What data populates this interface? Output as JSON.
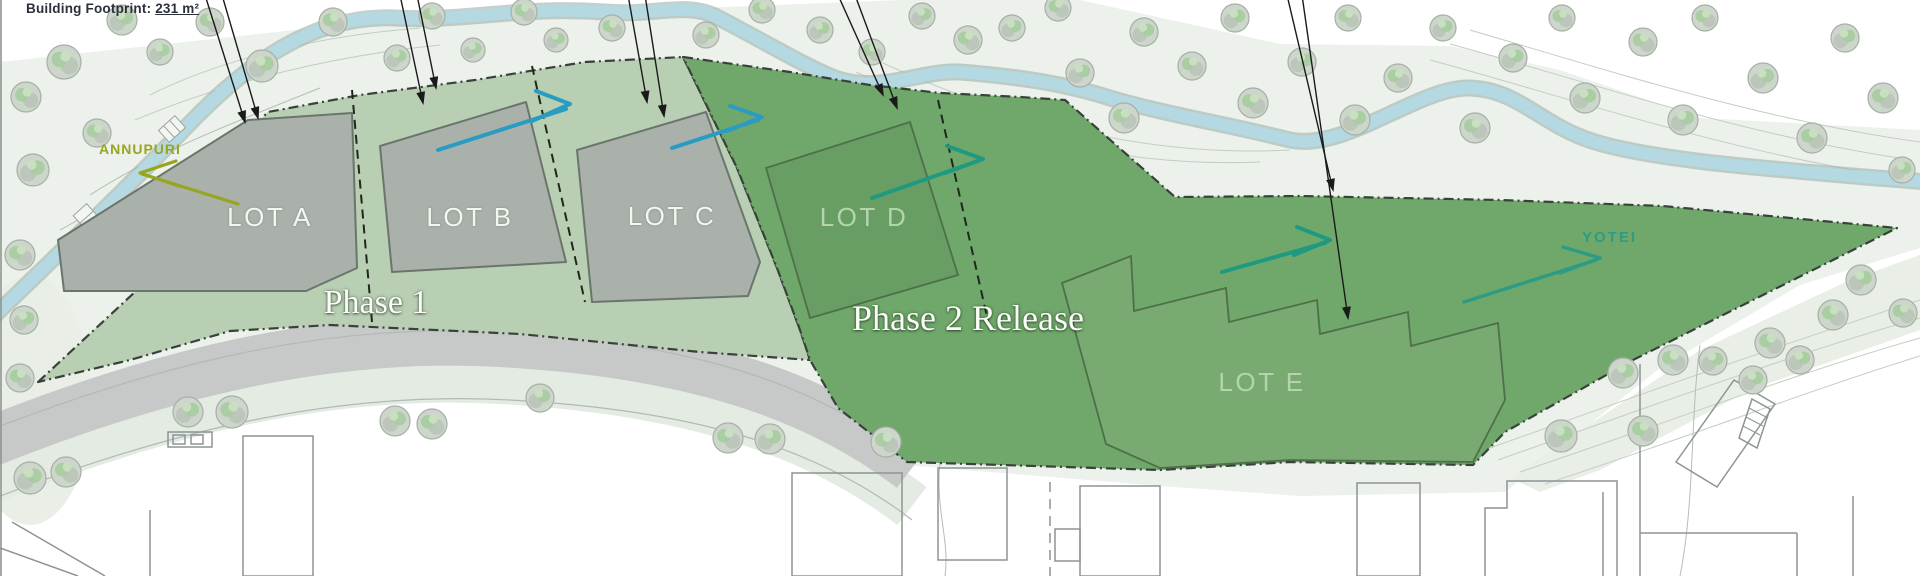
{
  "annotation": {
    "building_footprint_prefix": "Building Footprint: ",
    "building_footprint_value": "231 m²"
  },
  "phases": {
    "phase1_label": "Phase 1",
    "phase2_label": "Phase 2 Release"
  },
  "lots": [
    {
      "label": "LOT A",
      "area": "phase1"
    },
    {
      "label": "LOT B",
      "area": "phase1"
    },
    {
      "label": "LOT C",
      "area": "phase1"
    },
    {
      "label": "LOT D",
      "area": "phase2"
    },
    {
      "label": "LOT E",
      "area": "phase2"
    }
  ],
  "landmarks": {
    "west": "ANNUPURI",
    "east": "YOTEI"
  },
  "colors": {
    "band": "#ecf1eb",
    "phase1": "#b9cfb3",
    "phase2": "#6fa86a",
    "lot_fill": "#a9b1aa",
    "lot_stroke": "#6a756c",
    "lot_d_fill": "#689e63",
    "lot_e_fill": "#79aa72",
    "river": "#b5d9e3",
    "road": "#c6c9c8",
    "verge": "#e3ebe2",
    "boundary": "#38423a",
    "tree_fill": "#cdd6cb",
    "tree_stroke": "#a7afa6",
    "building_stroke": "#8d9494",
    "flow_blue": "#2a9cc2",
    "flow_teal": "#1f9a80",
    "annupuri": "#98a51e",
    "yotei": "#2d9b85",
    "label_white": "#f4f6f2",
    "label_light_green": "#b5d4ae",
    "footprint_text": "#2b313a"
  }
}
